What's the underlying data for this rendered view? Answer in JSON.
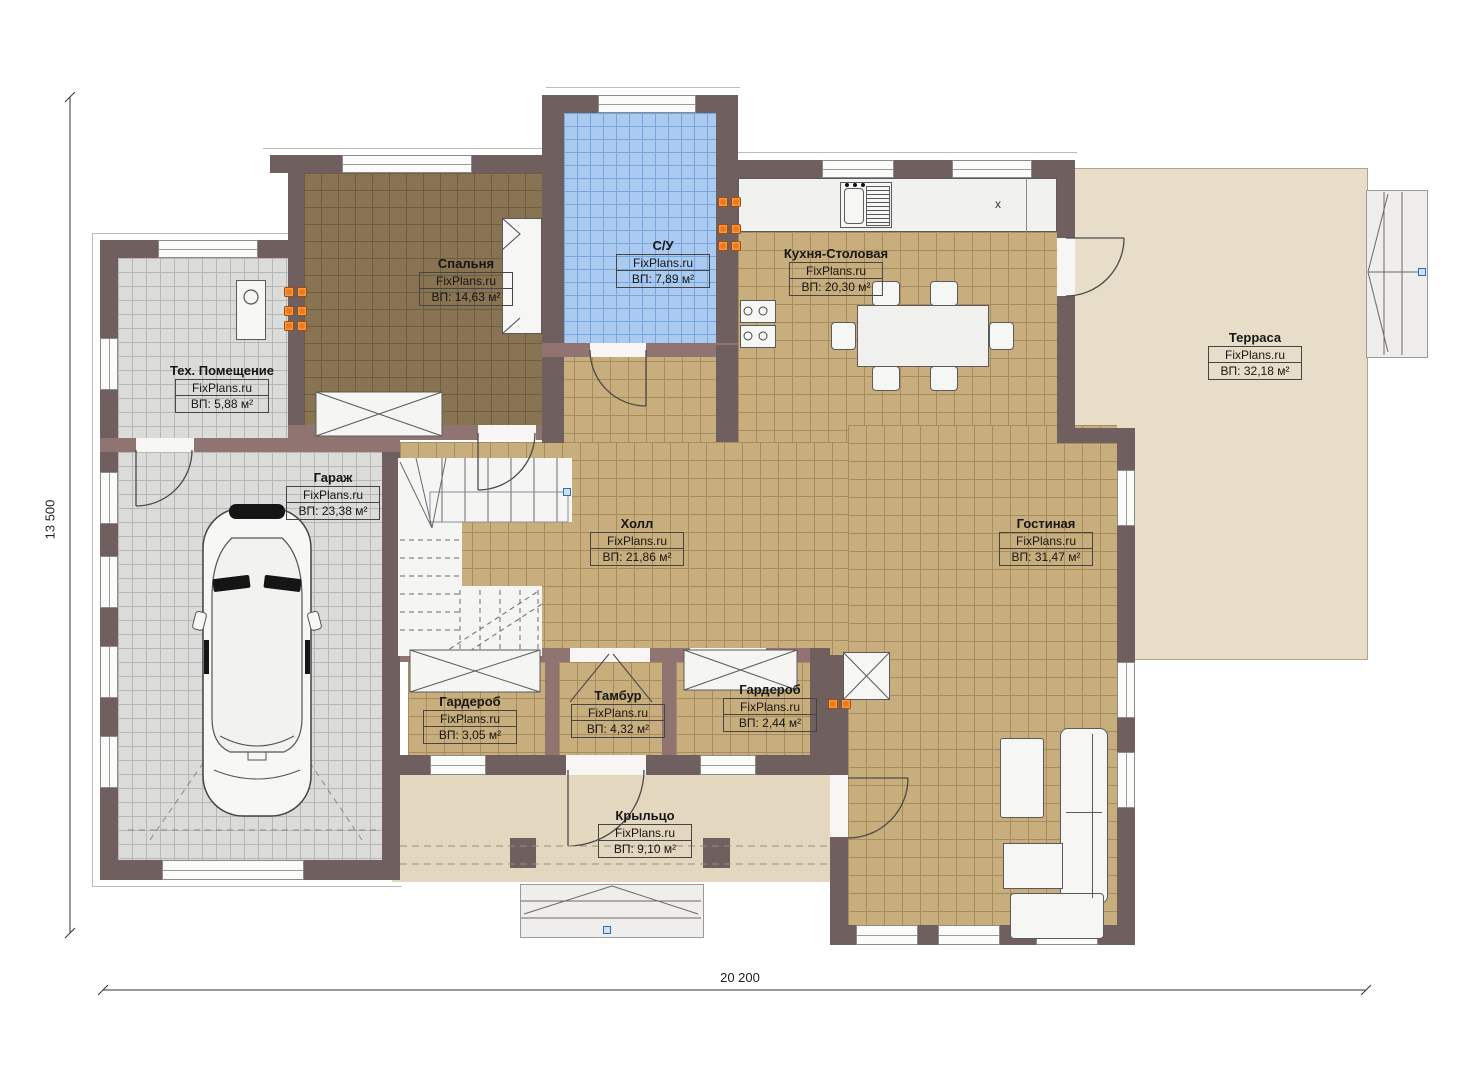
{
  "watermark": "FixPlans.ru",
  "dimensions": {
    "bottom": "20 200",
    "left": "13 500"
  },
  "annotations": {
    "counter_mark": "x"
  },
  "rooms": [
    {
      "name": "Спальня",
      "area": "ВП: 14,63 м²"
    },
    {
      "name": "С/У",
      "area": "ВП: 7,89 м²"
    },
    {
      "name": "Кухня-Столовая",
      "area": "ВП: 20,30 м²"
    },
    {
      "name": "Терраса",
      "area": "ВП: 32,18 м²"
    },
    {
      "name": "Тех. Помещение",
      "area": "ВП: 5,88 м²"
    },
    {
      "name": "Гараж",
      "area": "ВП: 23,38 м²"
    },
    {
      "name": "Холл",
      "area": "ВП: 21,86 м²"
    },
    {
      "name": "Гостиная",
      "area": "ВП: 31,47 м²"
    },
    {
      "name": "Гардероб",
      "area": "ВП: 3,05 м²"
    },
    {
      "name": "Тамбур",
      "area": "ВП: 4,32 м²"
    },
    {
      "name": "Гардероб",
      "area": "ВП: 2,44 м²"
    },
    {
      "name": "Крыльцо",
      "area": "ВП: 9,10 м²"
    }
  ],
  "colors": {
    "wall_dark": "#6f5f5e",
    "wall_light": "#8f7472",
    "floor_tile_tan": "#c9ae7d",
    "floor_bedroom": "#887352",
    "floor_bath": "#aacaf0",
    "floor_garage": "#dbdbd9",
    "terrace": "#e8ddc8",
    "porch": "#e4d7bf",
    "marker_orange": "#f07818",
    "marker_blue": "#2f6fae"
  }
}
